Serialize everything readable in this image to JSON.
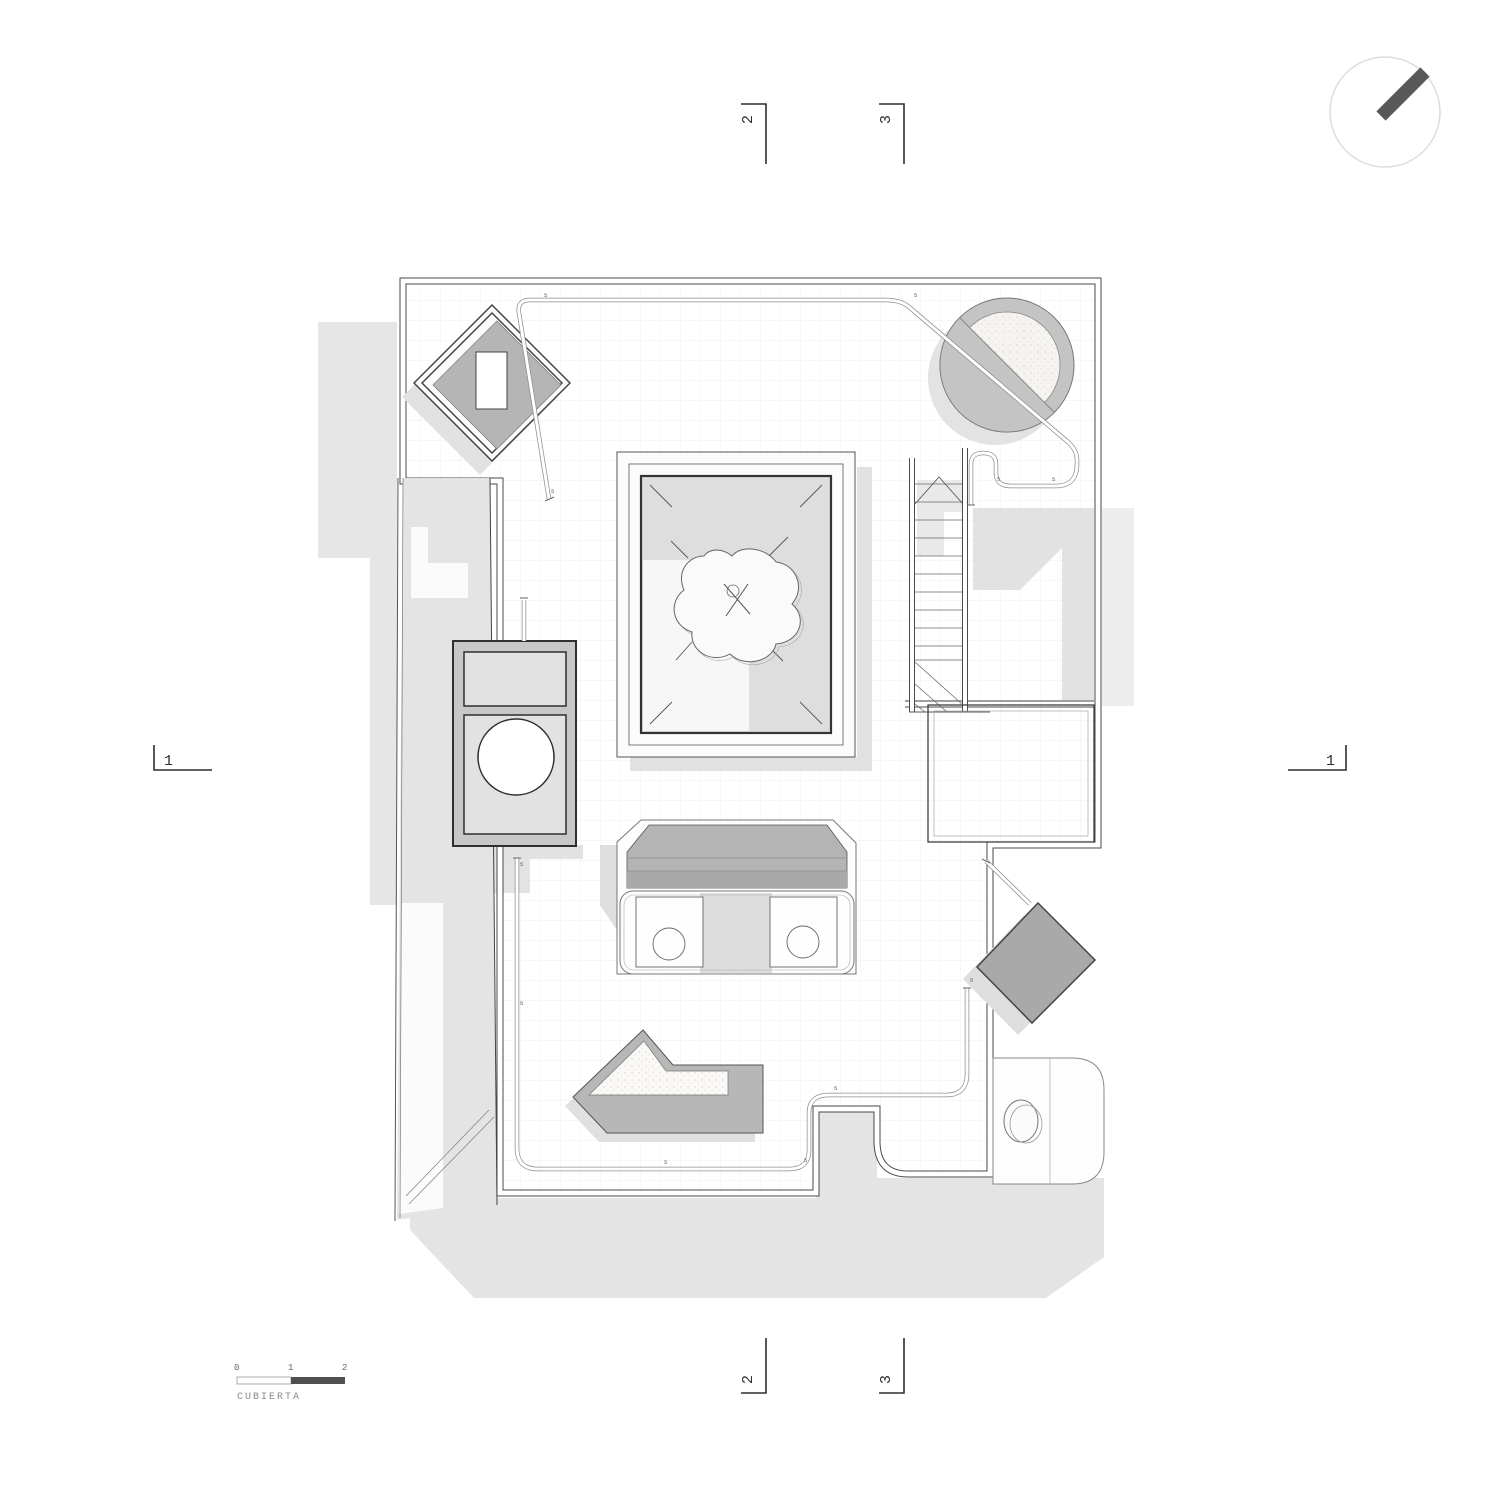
{
  "drawing": {
    "name": "CUBIERTA",
    "scale_ticks": [
      "0",
      "1",
      "2"
    ],
    "section_1": "1",
    "section_2": "2",
    "section_3": "3",
    "railing_tick": "5"
  },
  "colors": {
    "wall_line": "#4a4a4a",
    "shadow": "#e4e4e4",
    "object_gray": "#b7b7b7",
    "ring_gray": "#c4c4c4",
    "scale_dark_fill": "#4f4f4f",
    "grid_line": "#efe9e8",
    "north_bar": "#58585a"
  }
}
